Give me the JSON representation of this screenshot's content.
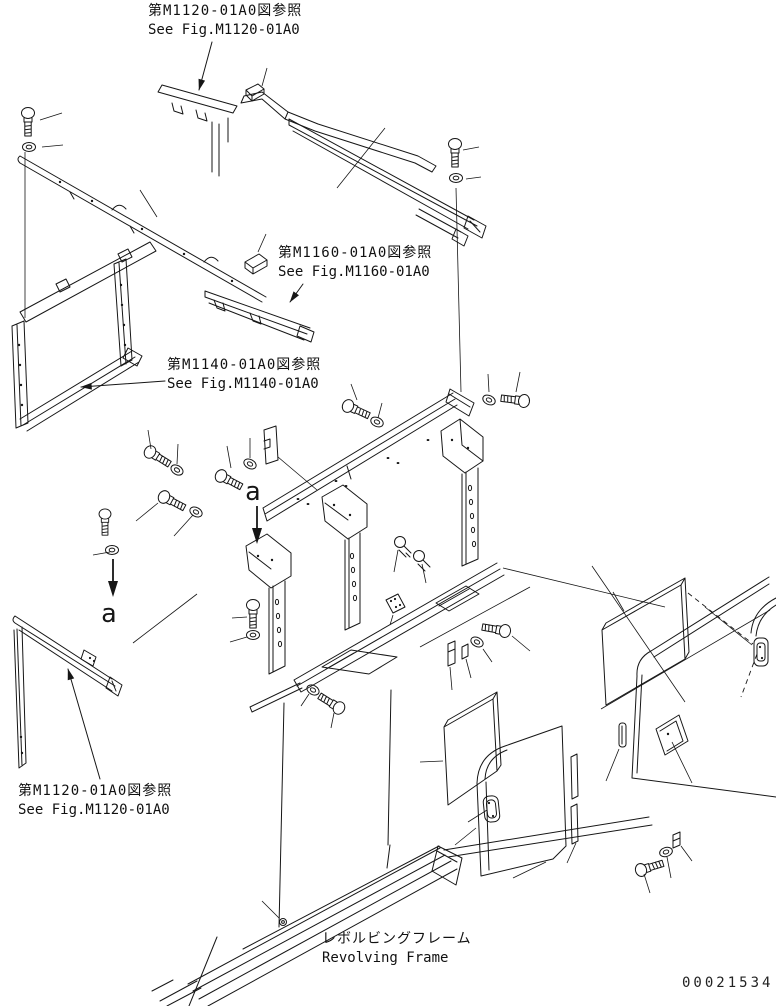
{
  "page": {
    "background_color": "#ffffff",
    "line_color": "#161616"
  },
  "figure_references": [
    {
      "id": "ref-top",
      "jp": "第M1120-01A0図参照",
      "en": "See Fig.M1120-01A0"
    },
    {
      "id": "ref-mid",
      "jp": "第M1160-01A0図参照",
      "en": "See Fig.M1160-01A0"
    },
    {
      "id": "ref-frame",
      "jp": "第M1140-01A0図参照",
      "en": "See Fig.M1140-01A0"
    },
    {
      "id": "ref-bottom-left",
      "jp": "第M1120-01A0図参照",
      "en": "See Fig.M1120-01A0"
    }
  ],
  "part_labels": {
    "revolving_frame_jp": "レボルビングフレーム",
    "revolving_frame_en": "Revolving Frame"
  },
  "section_markers": {
    "upper": "a",
    "lower": "a"
  },
  "drawing_number": "00021534"
}
